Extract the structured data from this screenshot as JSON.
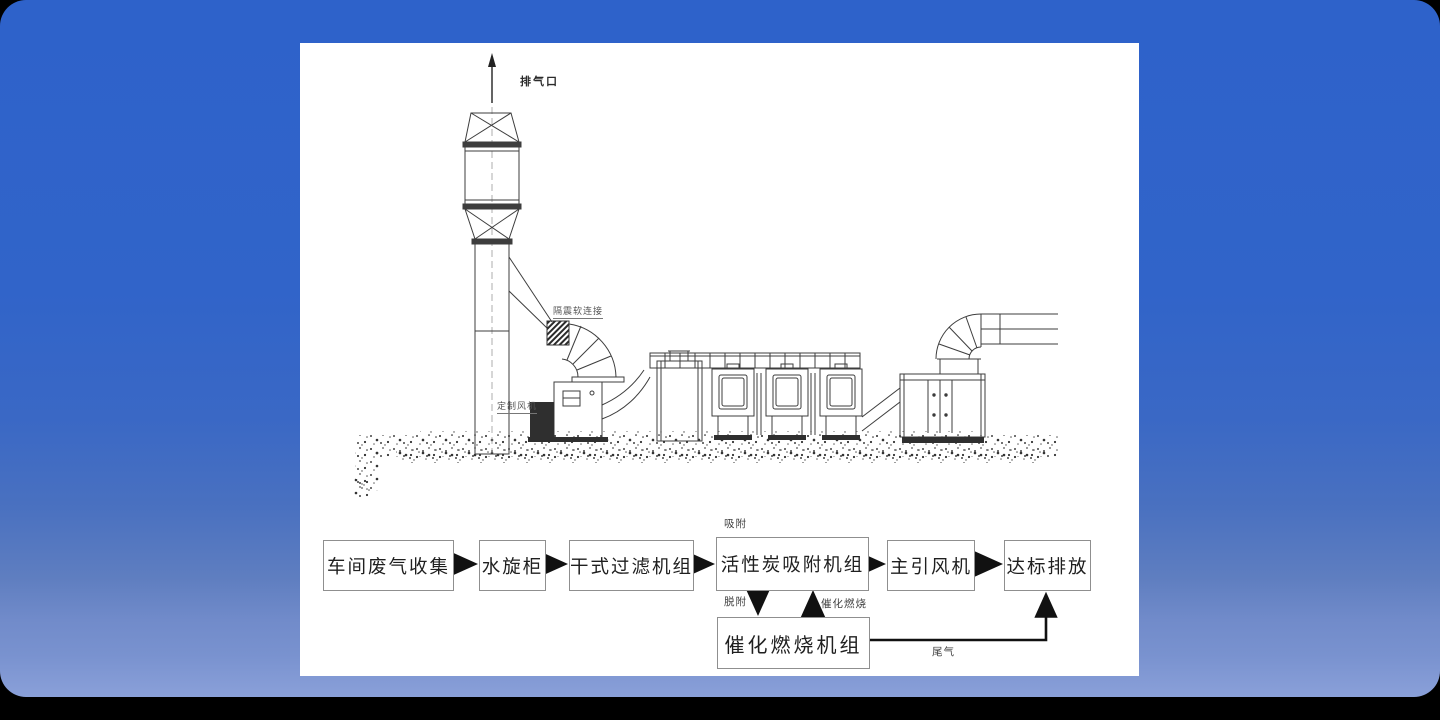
{
  "drawing": {
    "labels": {
      "exhaust_outlet": "排气口",
      "soft_connection": "隔震软连接",
      "custom_fan": "定制风机"
    }
  },
  "flowchart": {
    "boxes": [
      {
        "label": "车间废气收集"
      },
      {
        "label": "水旋柜"
      },
      {
        "label": "干式过滤机组"
      },
      {
        "label": "活性炭吸附机组"
      },
      {
        "label": "主引风机"
      },
      {
        "label": "达标排放"
      },
      {
        "label": "催化燃烧机组"
      }
    ],
    "edge_labels": {
      "adsorption": "吸附",
      "desorption": "脱附",
      "catalytic_combustion": "催化燃烧",
      "tail_gas": "尾气"
    }
  },
  "colors": {
    "background_top": "#2e62ca",
    "background_bottom": "#8aa0d9",
    "panel": "#ffffff",
    "line": "#3d3d3d",
    "arrow": "#111111"
  }
}
